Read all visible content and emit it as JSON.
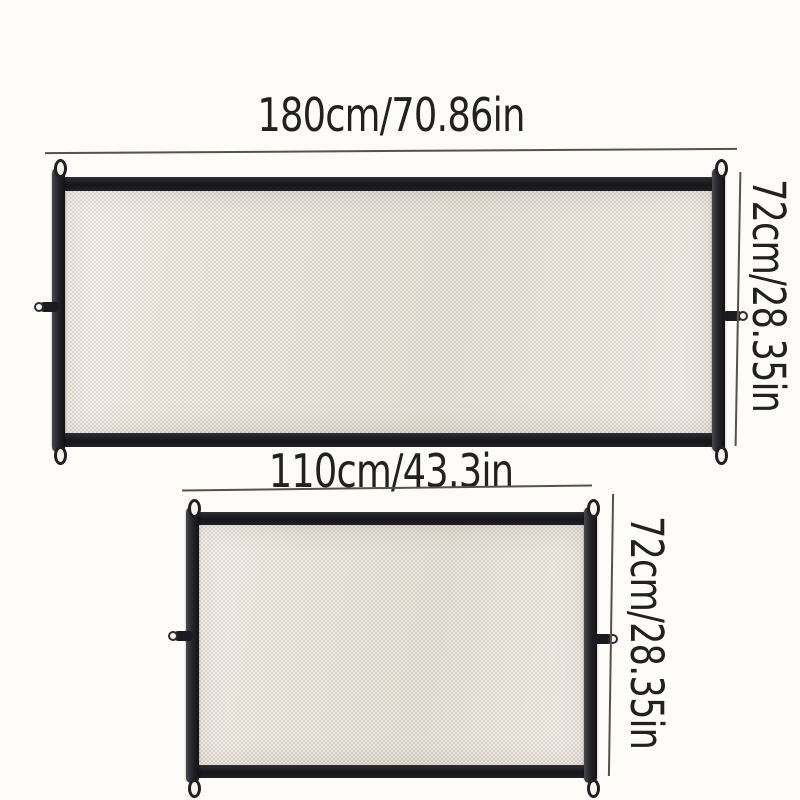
{
  "gates": [
    {
      "id": "large",
      "width_label": "180cm/70.86in",
      "height_label": "72cm/28.35in"
    },
    {
      "id": "small",
      "width_label": "110cm/43.3in",
      "height_label": "72cm/28.35in"
    }
  ],
  "colors": {
    "background": "#fdfcf8",
    "text": "#232120",
    "dimension_line": "#55514b",
    "frame_dark": "#17171a",
    "frame_side": "#26262b",
    "mesh_base": "#f2efe8",
    "mesh_weave": "#d9d2c8"
  }
}
